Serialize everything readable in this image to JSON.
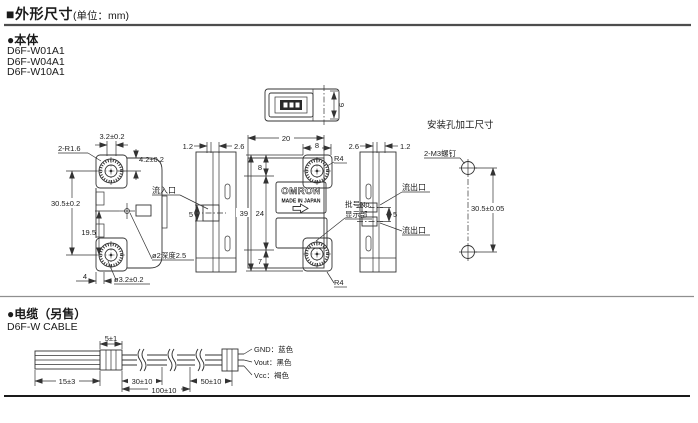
{
  "header": {
    "title": "■外形尺寸",
    "unit": "(单位：mm)"
  },
  "body_section": {
    "heading": "●本体",
    "models": [
      "D6F-W01A1",
      "D6F-W04A1",
      "D6F-W10A1"
    ]
  },
  "left_view": {
    "dim_top_width": "3.2±0.2",
    "label_corner_r": "2-R1.6",
    "dim_hole_offset": "4.2±0.2",
    "dim_hole_pitch": "30.5±0.2",
    "dim_center_hole": "19.5",
    "dim_bottom": "4",
    "label_hole_dia": "ø3.2±0.2",
    "label_depth_hole": "ø2深度2.5"
  },
  "inlet_view": {
    "dim_left": "1.2",
    "dim_right": "2.6",
    "label_inlet": "流入口",
    "dim_port": "5"
  },
  "top_view": {
    "dim_depth": "9"
  },
  "front_view": {
    "dim_width": "20",
    "dim_tab_width": "8",
    "label_r_top": "R4",
    "label_r_bottom": "R4",
    "dim_height": "39",
    "dim_mid_height": "24",
    "dim_top_height": "8",
    "dim_bottom_height": "7",
    "logo": "OMRON",
    "made_in": "MADE IN JAPAN",
    "lot_line1": "批号No.",
    "lot_line2": "显示部"
  },
  "outlet_view": {
    "dim_left": "2.6",
    "dim_right": "1.2",
    "label_outlet_top": "流出口",
    "label_outlet_bottom": "流出口",
    "dim_port": "5"
  },
  "mounting": {
    "title": "安装孔加工尺寸",
    "label_screws": "2-M3螺钉",
    "dim_pitch": "30.5±0.05"
  },
  "cable_section": {
    "heading": "●电缆（另售）",
    "subheading": "D6F-W CABLE",
    "dim_strip": "5±1",
    "wires": [
      {
        "label": "GND：蓝色"
      },
      {
        "label": "Vout：黑色"
      },
      {
        "label": "Vcc：褐色"
      }
    ],
    "dim_lead": "15±3",
    "dim_seg1": "30±10",
    "dim_seg2": "100±10",
    "dim_seg3": "50±10"
  },
  "colors": {
    "line": "#333333",
    "rule_dark": "#1a1a1a",
    "rule_gray": "#8f8f8f"
  }
}
